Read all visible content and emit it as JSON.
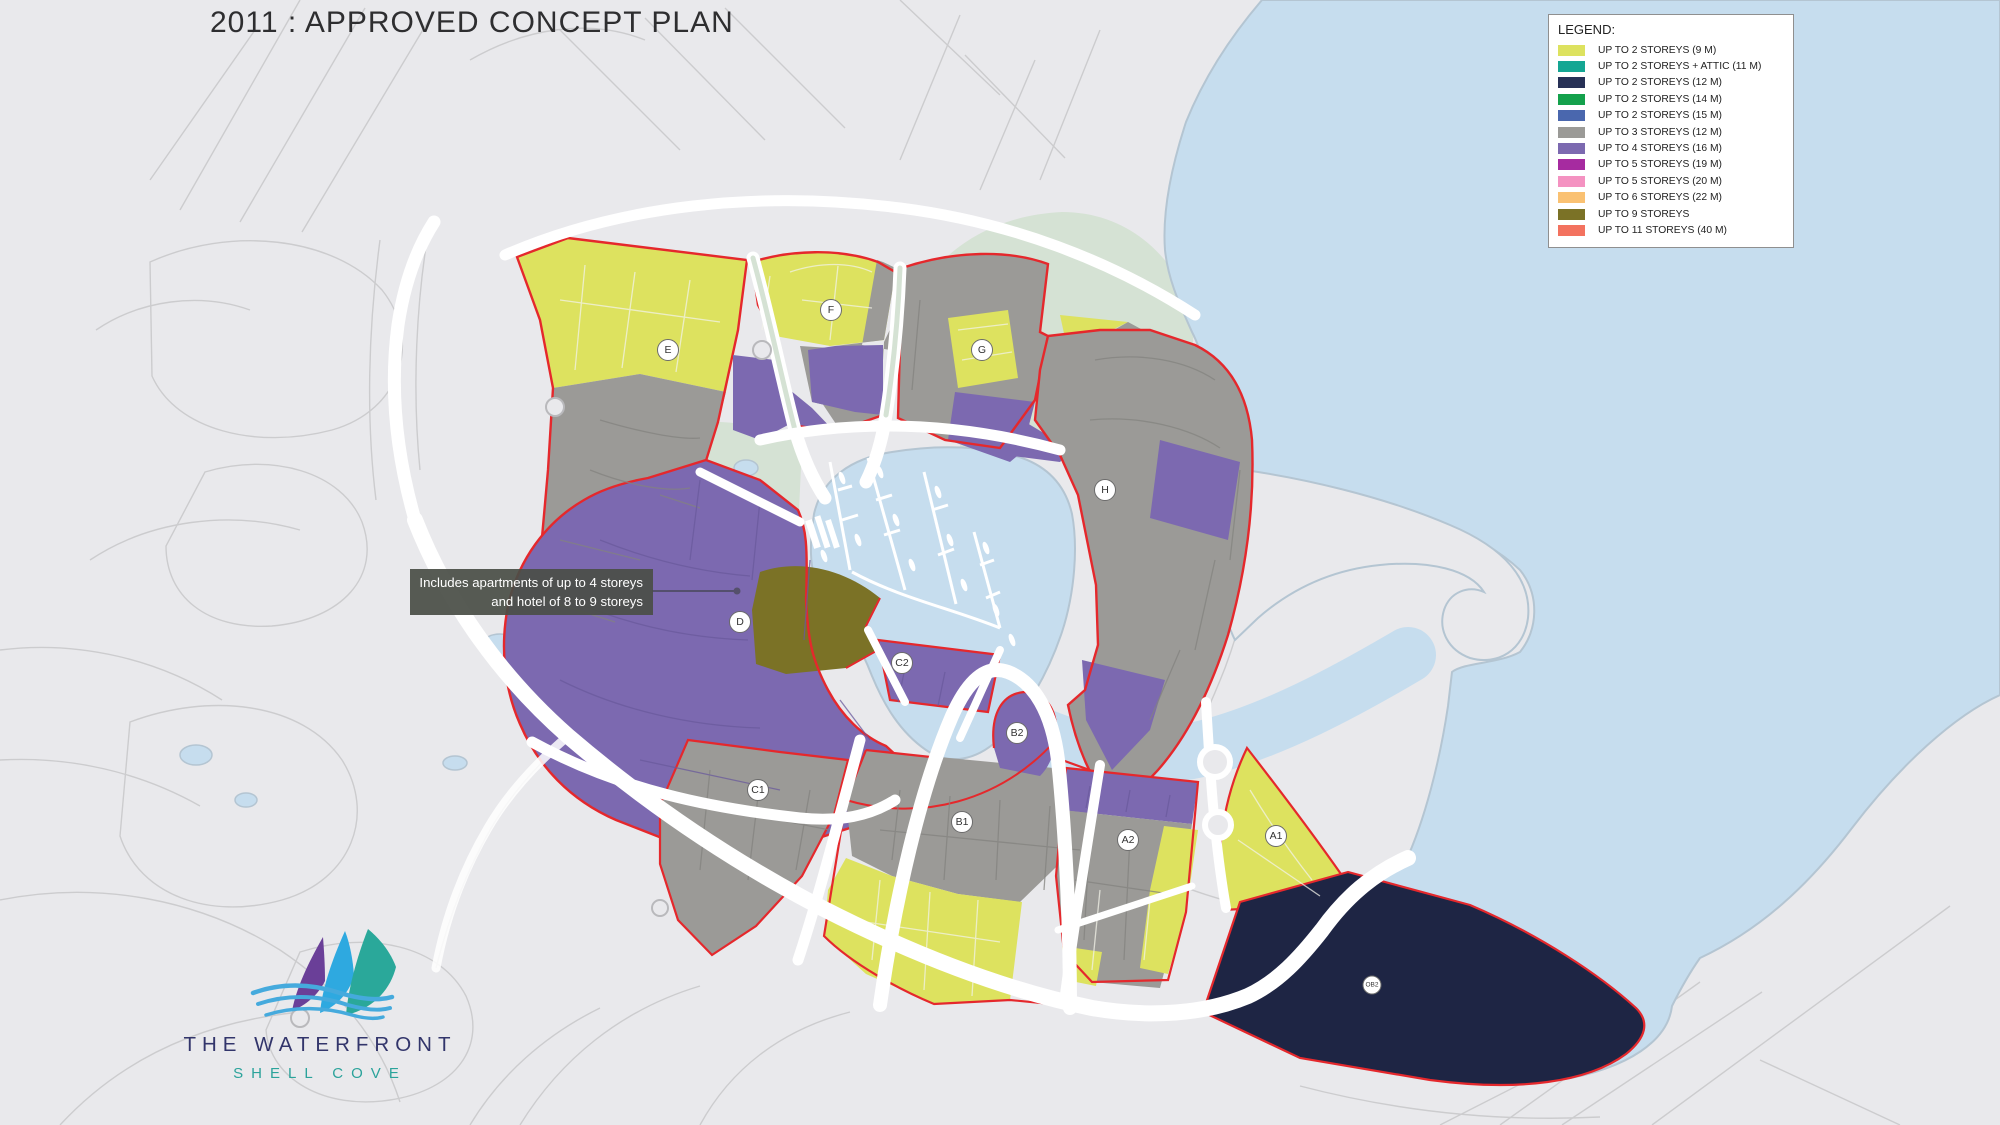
{
  "title": "2011 : APPROVED CONCEPT PLAN",
  "legend": {
    "title": "LEGEND:",
    "items": [
      {
        "label": "UP TO 2 STOREYS (9 M)",
        "color": "#dde25f"
      },
      {
        "label": "UP TO 2 STOREYS + ATTIC (11 M)",
        "color": "#14a693"
      },
      {
        "label": "UP TO 2 STOREYS (12 M)",
        "color": "#273156"
      },
      {
        "label": "UP TO 2 STOREYS (14 M)",
        "color": "#14a14c"
      },
      {
        "label": "UP TO 2 STOREYS (15 M)",
        "color": "#4a67ae"
      },
      {
        "label": "UP TO 3 STOREYS (12 M)",
        "color": "#9b9a97"
      },
      {
        "label": "UP TO 4 STOREYS (16 M)",
        "color": "#7c69b0"
      },
      {
        "label": "UP TO 5 STOREYS (19 M)",
        "color": "#a62ba0"
      },
      {
        "label": "UP TO 5 STOREYS (20 M)",
        "color": "#f492c1"
      },
      {
        "label": "UP TO 6 STOREYS (22 M)",
        "color": "#fac172"
      },
      {
        "label": "UP TO 9 STOREYS",
        "color": "#7b7226"
      },
      {
        "label": "UP TO 11 STOREYS (40 M)",
        "color": "#f3725f"
      }
    ]
  },
  "annotation": {
    "line1": "Includes apartments of up to 4 storeys",
    "line2": "and hotel of 8 to 9 storeys"
  },
  "logo": {
    "name": "THE WATERFRONT",
    "tagline": "SHELL COVE",
    "sail_colors": {
      "left": "#6a3f98",
      "middle": "#2ea9e0",
      "right": "#2aa89a"
    },
    "wave_color": "#45aadd"
  },
  "map": {
    "palette": {
      "land": "#e9e9ec",
      "water": "#c6ddee",
      "park": "#d5e2d4",
      "road": "#ffffff",
      "boundary_red": "#e5282c",
      "yellow": "#dde25f",
      "gray": "#9b9a97",
      "purple": "#7c69b0",
      "olive": "#7b7226",
      "navy": "#1e2544"
    },
    "zone_labels": [
      {
        "id": "E",
        "x": 668,
        "y": 350,
        "small": false
      },
      {
        "id": "F",
        "x": 831,
        "y": 310,
        "small": false
      },
      {
        "id": "G",
        "x": 982,
        "y": 350,
        "small": false
      },
      {
        "id": "H",
        "x": 1105,
        "y": 490,
        "small": false
      },
      {
        "id": "D",
        "x": 740,
        "y": 622,
        "small": false
      },
      {
        "id": "C2",
        "x": 902,
        "y": 663,
        "small": false
      },
      {
        "id": "C1",
        "x": 758,
        "y": 790,
        "small": false
      },
      {
        "id": "B2",
        "x": 1017,
        "y": 733,
        "small": false
      },
      {
        "id": "B1",
        "x": 962,
        "y": 822,
        "small": false
      },
      {
        "id": "A2",
        "x": 1128,
        "y": 840,
        "small": false
      },
      {
        "id": "A1",
        "x": 1276,
        "y": 836,
        "small": false
      },
      {
        "id": "OB2",
        "x": 1372,
        "y": 985,
        "small": true
      }
    ]
  }
}
